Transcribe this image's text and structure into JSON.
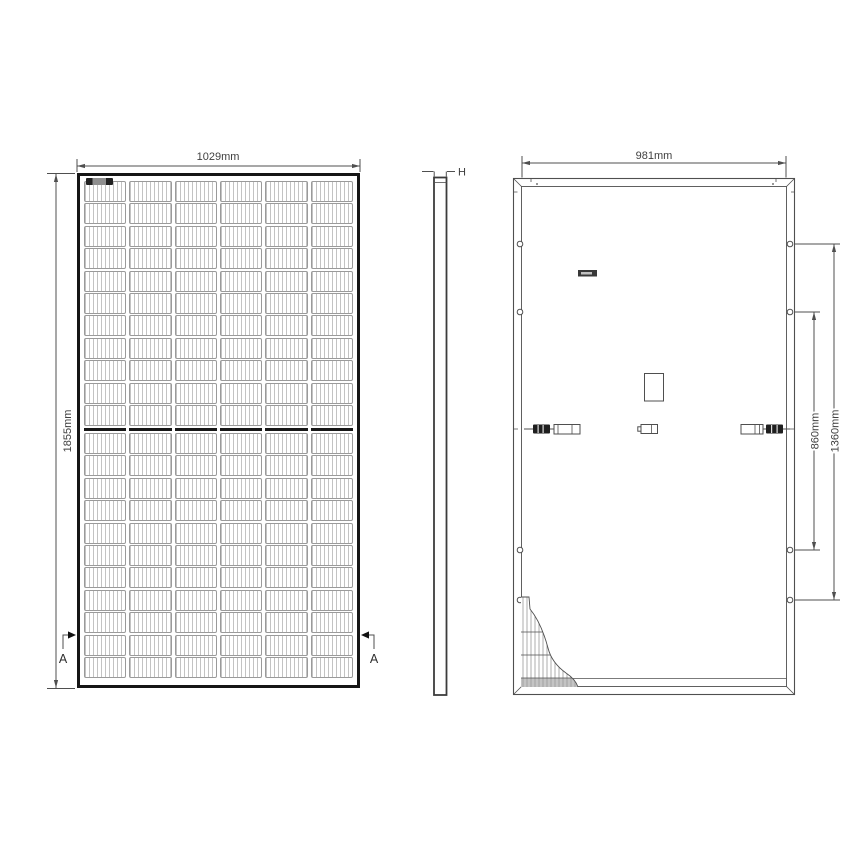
{
  "palette": {
    "line": "#4f4f4f",
    "text": "#3f3f3f",
    "frame": "#161616",
    "cell-line": "#c3c3c3",
    "connector": "#1f1f1f"
  },
  "drawing": {
    "views": {
      "front": {
        "width_dim": "1029mm",
        "height_dim": "1855mm",
        "section_label": "A",
        "grid": {
          "columns": 6,
          "rows_per_half": 11
        }
      },
      "side": {
        "thickness_dim": "H"
      },
      "back": {
        "width_dim": "981mm",
        "inner_mount_span_dim": "860mm",
        "outer_mount_span_dim": "1360mm"
      }
    }
  }
}
